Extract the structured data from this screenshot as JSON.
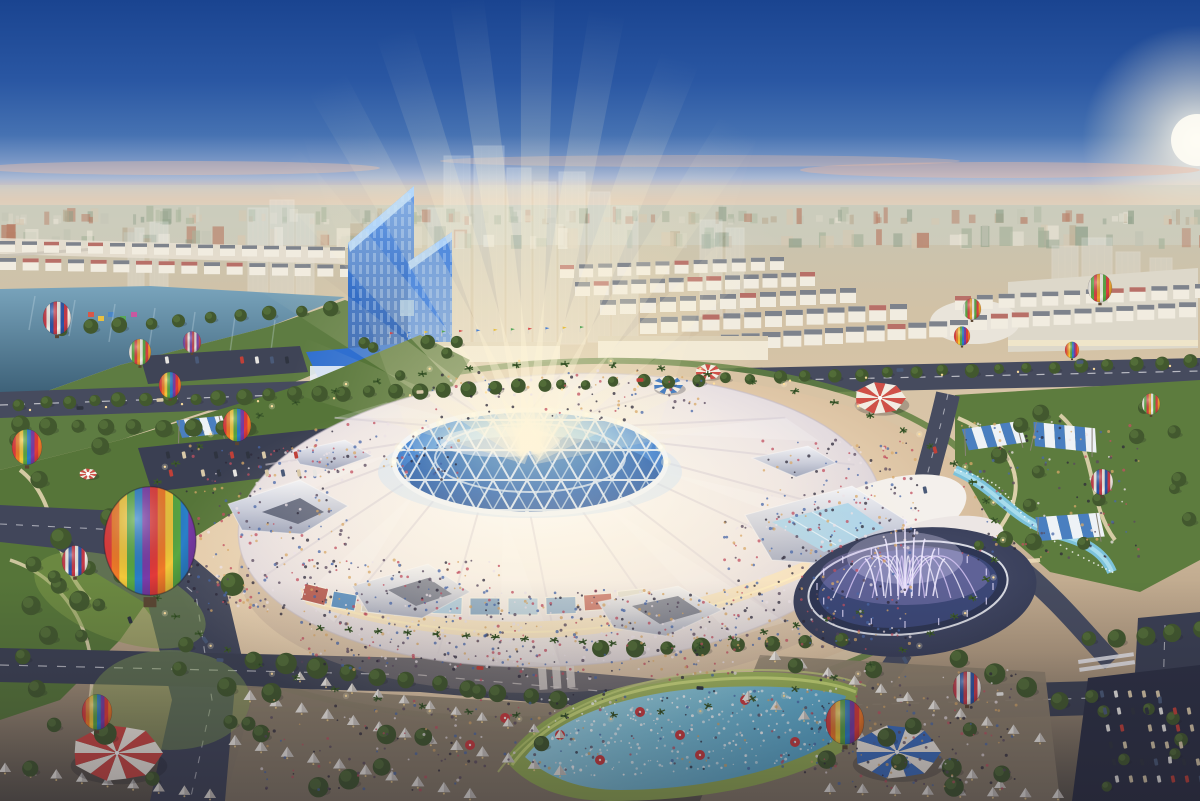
{
  "scene": {
    "description": "Aerial dusk architectural rendering of a vast circular exhibition dome with a blue geodesic crown and light beams, surrounded by plazas, parks, hot air balloons, striped tents, a musical fountain, splash pool, roads and a city skyline",
    "objects": [
      "sky",
      "sun-glow",
      "city-skyline",
      "river",
      "twin-blue-towers",
      "ghost-future-towers",
      "exhibition-dome",
      "geodesic-crown",
      "light-beams",
      "circular-plaza",
      "ring-boulevard",
      "musical-fountain",
      "splash-pool",
      "hot-air-balloons",
      "circus-tents",
      "market-tent-rows",
      "shade-canopies",
      "parks",
      "roads",
      "parking-lots",
      "crowds",
      "palm-trees"
    ],
    "colors": {
      "sky_top": "#1a4490",
      "sky_mid": "#3a68ae",
      "sky_light": "#8fadd3",
      "horizon_pink": "#eec6ab",
      "horizon_cream": "#e6d8c3",
      "sun_glow": "#fff8e8",
      "city_haze": "#ccd1c4",
      "river": "#40688a",
      "river_light": "#79a4bc",
      "tower_blue": "#2f69c4",
      "tower_light": "#7fb2ef",
      "tower_base": "#2f6fd0",
      "ghost": "#e6edf0",
      "ground": "#d3bda0",
      "plaza": "#ecd6b9",
      "plaza_edge": "#c9ae90",
      "road": "#42475b",
      "road_dark": "#31364a",
      "lane_line": "#e9e9ee",
      "park_green": "#5d7c3e",
      "park_dark": "#49652f",
      "lawn_lit": "#a9c25e",
      "lime": "#cfe07a",
      "path_cream": "#ead9b6",
      "tree": "#42582e",
      "palm": "#3d5a2c",
      "pool_cyan": "#7cc2da",
      "pool_deep": "#4f9cc0",
      "dome_white": "#faf6f1",
      "dome_shade": "#ddd5dc",
      "crown_blue": "#2c6ec6",
      "crown_light": "#9fd4f2",
      "strut_white": "#f2f6fb",
      "beam_warm": "#fff3d2",
      "facade_warm": "#f5e0bd",
      "fountain_plaza": "#3a3f55",
      "fountain_glow": "#b9a6e8",
      "fountain_jet": "#efe9ff",
      "tent_red": "#cf4742",
      "tent_blue": "#3d6fc0",
      "tent_white": "#f3ece2",
      "canopy_blue": "#4a7fc0",
      "umbrella_red": "#cc3b3e",
      "light_warm": "#ffdf9f"
    },
    "balloon_palettes": {
      "rainbow": [
        "#e23a3a",
        "#f07a28",
        "#f2c83a",
        "#58a843",
        "#2a7fc8",
        "#7a3ba8"
      ],
      "rwb": [
        "#c83a48",
        "#f0ece4",
        "#2a55a8"
      ],
      "green": [
        "#f0ece4",
        "#58a843",
        "#d84040",
        "#e8a030"
      ],
      "purple": [
        "#7a4aa8",
        "#c04858",
        "#e8e0d8"
      ]
    },
    "crowd_colors": [
      "#2e2a3a",
      "#5a4a5e",
      "#ece2e6",
      "#c25060",
      "#4a68a8",
      "#d8a868"
    ],
    "car_colors": [
      "#e8e6e2",
      "#2f3440",
      "#c04038",
      "#4a5a78",
      "#d8c8a8"
    ],
    "balloons": [
      {
        "x": 57,
        "y": 318,
        "s": 14,
        "type": "rwb"
      },
      {
        "x": 140,
        "y": 352,
        "s": 11,
        "type": "green"
      },
      {
        "x": 192,
        "y": 342,
        "s": 9,
        "type": "purple"
      },
      {
        "x": 170,
        "y": 385,
        "s": 11,
        "type": "rainbow"
      },
      {
        "x": 27,
        "y": 447,
        "s": 15,
        "type": "rainbow"
      },
      {
        "x": 237,
        "y": 425,
        "s": 14,
        "type": "rainbow"
      },
      {
        "x": 150,
        "y": 541,
        "s": 46,
        "type": "rainbow"
      },
      {
        "x": 75,
        "y": 561,
        "s": 13,
        "type": "rwb"
      },
      {
        "x": 97,
        "y": 712,
        "s": 15,
        "type": "rainbow"
      },
      {
        "x": 845,
        "y": 722,
        "s": 19,
        "type": "rainbow"
      },
      {
        "x": 967,
        "y": 688,
        "s": 14,
        "type": "rwb"
      },
      {
        "x": 972,
        "y": 309,
        "s": 9,
        "type": "green"
      },
      {
        "x": 1100,
        "y": 288,
        "s": 12,
        "type": "green"
      },
      {
        "x": 962,
        "y": 336,
        "s": 8,
        "type": "rainbow"
      },
      {
        "x": 1072,
        "y": 350,
        "s": 7,
        "type": "rainbow"
      },
      {
        "x": 1102,
        "y": 482,
        "s": 11,
        "type": "rwb"
      },
      {
        "x": 1151,
        "y": 404,
        "s": 9,
        "type": "green"
      }
    ],
    "beams": [
      {
        "a": -70,
        "l": 250,
        "w": 30,
        "o": 0.45
      },
      {
        "a": -55,
        "l": 320,
        "w": 26,
        "o": 0.5
      },
      {
        "a": -41,
        "l": 380,
        "w": 24,
        "o": 0.55
      },
      {
        "a": -29,
        "l": 420,
        "w": 22,
        "o": 0.55
      },
      {
        "a": -18,
        "l": 440,
        "w": 20,
        "o": 0.6
      },
      {
        "a": -8,
        "l": 455,
        "w": 18,
        "o": 0.65
      },
      {
        "a": 1,
        "l": 460,
        "w": 18,
        "o": 0.65
      },
      {
        "a": 10,
        "l": 445,
        "w": 19,
        "o": 0.6
      },
      {
        "a": 21,
        "l": 420,
        "w": 21,
        "o": 0.6
      },
      {
        "a": 33,
        "l": 385,
        "w": 23,
        "o": 0.55
      },
      {
        "a": 47,
        "l": 330,
        "w": 25,
        "o": 0.5
      },
      {
        "a": 62,
        "l": 260,
        "w": 28,
        "o": 0.45
      },
      {
        "a": 75,
        "l": 200,
        "w": 30,
        "o": 0.4
      }
    ],
    "circus_tents": [
      {
        "x": 117,
        "y": 753,
        "r": 46,
        "c": "#cf4742"
      },
      {
        "x": 897,
        "y": 752,
        "r": 44,
        "c": "#3d6fc0"
      },
      {
        "x": 880,
        "y": 398,
        "r": 26,
        "c": "#d05048"
      },
      {
        "x": 668,
        "y": 385,
        "r": 15,
        "c": "#4a7fc0"
      },
      {
        "x": 708,
        "y": 372,
        "r": 13,
        "c": "#d05048"
      },
      {
        "x": 88,
        "y": 474,
        "r": 9,
        "c": "#d05048"
      }
    ],
    "canopies": [
      {
        "x": 992,
        "y": 436,
        "w": 58,
        "h": 22,
        "rot": -8
      },
      {
        "x": 1063,
        "y": 437,
        "w": 62,
        "h": 24,
        "rot": 6
      },
      {
        "x": 1068,
        "y": 527,
        "w": 64,
        "h": 24,
        "rot": -4
      },
      {
        "x": 200,
        "y": 427,
        "w": 46,
        "h": 18,
        "rot": -6
      }
    ],
    "tent_rows": [
      {
        "x1": 250,
        "y1": 700,
        "x2": 560,
        "y2": 775,
        "n": 13,
        "s": 13
      },
      {
        "x1": 235,
        "y1": 745,
        "x2": 470,
        "y2": 798,
        "n": 10,
        "s": 13
      },
      {
        "x1": 300,
        "y1": 680,
        "x2": 560,
        "y2": 738,
        "n": 11,
        "s": 11
      },
      {
        "x1": 5,
        "y1": 772,
        "x2": 210,
        "y2": 798,
        "n": 9,
        "s": 12
      },
      {
        "x1": 775,
        "y1": 660,
        "x2": 1040,
        "y2": 742,
        "n": 11,
        "s": 12
      },
      {
        "x1": 748,
        "y1": 700,
        "x2": 1000,
        "y2": 788,
        "n": 10,
        "s": 12
      },
      {
        "x1": 830,
        "y1": 792,
        "x2": 1058,
        "y2": 798,
        "n": 8,
        "s": 12
      }
    ],
    "umbrellas": [
      {
        "x": 560,
        "y": 735
      },
      {
        "x": 600,
        "y": 760
      },
      {
        "x": 640,
        "y": 712
      },
      {
        "x": 700,
        "y": 755
      },
      {
        "x": 745,
        "y": 700
      },
      {
        "x": 795,
        "y": 742
      },
      {
        "x": 560,
        "y": 700
      },
      {
        "x": 680,
        "y": 735
      },
      {
        "x": 505,
        "y": 718
      },
      {
        "x": 470,
        "y": 745
      }
    ],
    "building_bands": [
      {
        "x": 0,
        "y": 193,
        "w": 1200,
        "h": 28,
        "n": 150,
        "hmin": 5,
        "hmax": 16,
        "wmin": 3,
        "wmax": 9,
        "op": 0.65
      },
      {
        "x": 0,
        "y": 215,
        "w": 1200,
        "h": 30,
        "n": 100,
        "hmin": 8,
        "hmax": 22,
        "wmin": 5,
        "wmax": 14,
        "op": 0.75
      }
    ],
    "building_palette": [
      "#e9e4d6",
      "#d8d5c6",
      "#c2c4b4",
      "#a8b49c",
      "#8fa08a",
      "#b8a88e",
      "#d8c8b0",
      "#b87c64"
    ],
    "ghost_towers": [
      {
        "x": 444,
        "y": 156,
        "w": 26,
        "h": 186
      },
      {
        "x": 474,
        "y": 146,
        "w": 30,
        "h": 198
      },
      {
        "x": 507,
        "y": 168,
        "w": 24,
        "h": 176
      },
      {
        "x": 534,
        "y": 182,
        "w": 22,
        "h": 160
      },
      {
        "x": 559,
        "y": 172,
        "w": 26,
        "h": 172
      },
      {
        "x": 588,
        "y": 192,
        "w": 22,
        "h": 150
      },
      {
        "x": 428,
        "y": 208,
        "w": 18,
        "h": 134
      },
      {
        "x": 612,
        "y": 206,
        "w": 26,
        "h": 136
      },
      {
        "x": 248,
        "y": 208,
        "w": 20,
        "h": 86
      },
      {
        "x": 270,
        "y": 200,
        "w": 24,
        "h": 96
      },
      {
        "x": 150,
        "y": 222,
        "w": 18,
        "h": 70
      },
      {
        "x": 128,
        "y": 228,
        "w": 16,
        "h": 62
      },
      {
        "x": 296,
        "y": 214,
        "w": 18,
        "h": 80
      },
      {
        "x": 1052,
        "y": 246,
        "w": 26,
        "h": 84
      },
      {
        "x": 1082,
        "y": 238,
        "w": 30,
        "h": 94
      },
      {
        "x": 1116,
        "y": 252,
        "w": 24,
        "h": 80
      },
      {
        "x": 1150,
        "y": 258,
        "w": 22,
        "h": 72
      },
      {
        "x": 700,
        "y": 220,
        "w": 22,
        "h": 96
      },
      {
        "x": 726,
        "y": 228,
        "w": 18,
        "h": 86
      }
    ],
    "shophouse_rows": [
      {
        "x1": 560,
        "y1": 278,
        "x2": 770,
        "y2": 270,
        "n": 12,
        "w": 14,
        "h": 13
      },
      {
        "x1": 575,
        "y1": 296,
        "x2": 800,
        "y2": 286,
        "n": 13,
        "w": 15,
        "h": 14
      },
      {
        "x1": 600,
        "y1": 315,
        "x2": 840,
        "y2": 303,
        "n": 13,
        "w": 16,
        "h": 15
      },
      {
        "x1": 640,
        "y1": 334,
        "x2": 890,
        "y2": 320,
        "n": 13,
        "w": 17,
        "h": 16
      },
      {
        "x1": 700,
        "y1": 352,
        "x2": 950,
        "y2": 336,
        "n": 13,
        "w": 18,
        "h": 16
      },
      {
        "x1": 955,
        "y1": 310,
        "x2": 1195,
        "y2": 298,
        "n": 12,
        "w": 16,
        "h": 14
      },
      {
        "x1": 970,
        "y1": 330,
        "x2": 1200,
        "y2": 316,
        "n": 12,
        "w": 17,
        "h": 15
      },
      {
        "x1": 0,
        "y1": 252,
        "x2": 330,
        "y2": 258,
        "n": 16,
        "w": 15,
        "h": 11
      },
      {
        "x1": 0,
        "y1": 270,
        "x2": 340,
        "y2": 277,
        "n": 16,
        "w": 16,
        "h": 12
      }
    ],
    "tree_rows": [
      {
        "x1": 20,
        "y1": 404,
        "x2": 545,
        "y2": 386,
        "n": 22,
        "r": 7
      },
      {
        "x1": 560,
        "y1": 385,
        "x2": 1190,
        "y2": 362,
        "n": 24,
        "r": 6
      },
      {
        "x1": 20,
        "y1": 425,
        "x2": 250,
        "y2": 430,
        "n": 9,
        "r": 8
      },
      {
        "x1": 255,
        "y1": 660,
        "x2": 560,
        "y2": 700,
        "n": 11,
        "r": 9
      },
      {
        "x1": 600,
        "y1": 650,
        "x2": 840,
        "y2": 640,
        "n": 8,
        "r": 8
      },
      {
        "x1": 60,
        "y1": 330,
        "x2": 330,
        "y2": 308,
        "n": 10,
        "r": 7
      },
      {
        "x1": 1090,
        "y1": 640,
        "x2": 1200,
        "y2": 630,
        "n": 5,
        "r": 8
      },
      {
        "x1": 960,
        "y1": 660,
        "x2": 1060,
        "y2": 700,
        "n": 4,
        "r": 9
      }
    ],
    "tree_scatter": [
      {
        "x": 10,
        "y": 440,
        "w": 120,
        "h": 200,
        "n": 14,
        "rmin": 6,
        "rmax": 11
      },
      {
        "x": 960,
        "y": 400,
        "w": 230,
        "h": 160,
        "n": 16,
        "rmin": 5,
        "rmax": 9
      },
      {
        "x": 240,
        "y": 690,
        "w": 330,
        "h": 100,
        "n": 10,
        "rmin": 7,
        "rmax": 11
      },
      {
        "x": 780,
        "y": 660,
        "w": 270,
        "h": 130,
        "n": 10,
        "rmin": 7,
        "rmax": 10
      },
      {
        "x": 0,
        "y": 560,
        "w": 240,
        "h": 230,
        "n": 12,
        "rmin": 7,
        "rmax": 12
      },
      {
        "x": 350,
        "y": 340,
        "w": 120,
        "h": 40,
        "n": 6,
        "rmin": 5,
        "rmax": 8
      },
      {
        "x": 1090,
        "y": 690,
        "w": 110,
        "h": 100,
        "n": 8,
        "rmin": 5,
        "rmax": 8
      }
    ],
    "palm_ring": {
      "cx": 565,
      "cy": 540,
      "rx": 432,
      "ry": 176,
      "n": 56
    },
    "palm_rows": [
      {
        "x1": 320,
        "y1": 628,
        "x2": 700,
        "y2": 648,
        "n": 14
      },
      {
        "x1": 700,
        "y1": 645,
        "x2": 860,
        "y2": 612,
        "n": 6
      }
    ],
    "crowd_regions": [
      {
        "x": 185,
        "y": 445,
        "w": 165,
        "h": 170,
        "n": 260
      },
      {
        "x": 300,
        "y": 560,
        "w": 200,
        "h": 110,
        "n": 260
      },
      {
        "x": 480,
        "y": 590,
        "w": 260,
        "h": 90,
        "n": 300
      },
      {
        "x": 720,
        "y": 520,
        "w": 200,
        "h": 130,
        "n": 260
      },
      {
        "x": 760,
        "y": 440,
        "w": 160,
        "h": 90,
        "n": 140
      },
      {
        "x": 300,
        "y": 420,
        "w": 160,
        "h": 60,
        "n": 80
      },
      {
        "x": 960,
        "y": 420,
        "w": 180,
        "h": 140,
        "n": 140
      },
      {
        "x": 530,
        "y": 690,
        "w": 300,
        "h": 80,
        "n": 120
      },
      {
        "x": 800,
        "y": 670,
        "w": 220,
        "h": 120,
        "n": 160
      },
      {
        "x": 260,
        "y": 700,
        "w": 260,
        "h": 90,
        "n": 110
      },
      {
        "x": 430,
        "y": 370,
        "w": 280,
        "h": 50,
        "n": 90
      }
    ],
    "car_grids": [
      {
        "x": 1102,
        "y": 694,
        "cols": 7,
        "rows": 6,
        "dx": 14,
        "dy": 17,
        "rot": -6
      },
      {
        "x": 152,
        "y": 455,
        "cols": 11,
        "rows": 2,
        "dx": 16,
        "dy": 18,
        "rot": -7
      },
      {
        "x": 152,
        "y": 360,
        "cols": 10,
        "rows": 1,
        "dx": 15,
        "dy": 0,
        "rot": -4
      }
    ],
    "road_cars": [
      {
        "x": 80,
        "y": 408,
        "r": -2
      },
      {
        "x": 160,
        "y": 400,
        "r": -3
      },
      {
        "x": 420,
        "y": 392,
        "r": -3
      },
      {
        "x": 640,
        "y": 380,
        "r": -2
      },
      {
        "x": 900,
        "y": 370,
        "r": -2
      },
      {
        "x": 1080,
        "y": 362,
        "r": -2
      },
      {
        "x": 220,
        "y": 660,
        "r": 4
      },
      {
        "x": 480,
        "y": 668,
        "r": 4
      },
      {
        "x": 700,
        "y": 688,
        "r": 3
      },
      {
        "x": 900,
        "y": 700,
        "r": -2
      },
      {
        "x": 1000,
        "y": 694,
        "r": -3
      },
      {
        "x": 1160,
        "y": 700,
        "r": 85
      },
      {
        "x": 1170,
        "y": 760,
        "r": 85
      },
      {
        "x": 935,
        "y": 450,
        "r": 75
      },
      {
        "x": 925,
        "y": 490,
        "r": 78
      },
      {
        "x": 905,
        "y": 660,
        "r": 60
      },
      {
        "x": 130,
        "y": 620,
        "r": 70
      },
      {
        "x": 205,
        "y": 640,
        "r": 55
      }
    ],
    "streetlights": {
      "ring_n": 30,
      "boulevard_n": 16
    },
    "billboards": [
      {
        "x": 303,
        "y": 586,
        "w": 24,
        "h": 17,
        "rot": 14,
        "c": "#b05048"
      },
      {
        "x": 332,
        "y": 593,
        "w": 24,
        "h": 16,
        "rot": 10,
        "c": "#4a86c0"
      },
      {
        "x": 362,
        "y": 598,
        "w": 24,
        "h": 15,
        "rot": 7,
        "c": "#d8d4c8"
      },
      {
        "x": 395,
        "y": 601,
        "w": 26,
        "h": 15,
        "rot": 4,
        "c": "#8fb8d8"
      },
      {
        "x": 432,
        "y": 597,
        "w": 30,
        "h": 17,
        "rot": 2,
        "c": "#9fc4e0"
      },
      {
        "x": 470,
        "y": 598,
        "w": 30,
        "h": 17,
        "rot": 0,
        "c": "#6f98c0"
      },
      {
        "x": 508,
        "y": 598,
        "w": 30,
        "h": 17,
        "rot": 0,
        "c": "#a8c8e0"
      },
      {
        "x": 546,
        "y": 597,
        "w": 30,
        "h": 17,
        "rot": -2,
        "c": "#88accf"
      },
      {
        "x": 584,
        "y": 594,
        "w": 28,
        "h": 16,
        "rot": -4,
        "c": "#c05a50"
      },
      {
        "x": 618,
        "y": 590,
        "w": 26,
        "h": 15,
        "rot": -6,
        "c": "#e0ddd0"
      }
    ],
    "flag_row": {
      "x1": 390,
      "y1": 338,
      "x2": 580,
      "y2": 332,
      "n": 12
    },
    "flag_colors": [
      "#d84848",
      "#4a7fd0",
      "#e8c040",
      "#58a85a"
    ],
    "shore_decor": [
      {
        "x": 88,
        "y": 312,
        "c": "#d85848"
      },
      {
        "x": 98,
        "y": 316,
        "c": "#e8c040"
      },
      {
        "x": 108,
        "y": 312,
        "c": "#4a86c8"
      },
      {
        "x": 120,
        "y": 316,
        "c": "#58a85a"
      },
      {
        "x": 131,
        "y": 312,
        "c": "#c858a0"
      }
    ],
    "splash_jets": {
      "n": 230,
      "quad": [
        540,
        697,
        845,
        687,
        822,
        762,
        562,
        782
      ]
    },
    "fountain": {
      "cx": 905,
      "cy": 588
    },
    "crown": {
      "cx": 530,
      "cy": 462,
      "rx": 136,
      "ry": 52
    },
    "dome": {
      "cx": 560,
      "cy": 520,
      "rx": 322,
      "ry": 146,
      "folds": 16
    }
  }
}
